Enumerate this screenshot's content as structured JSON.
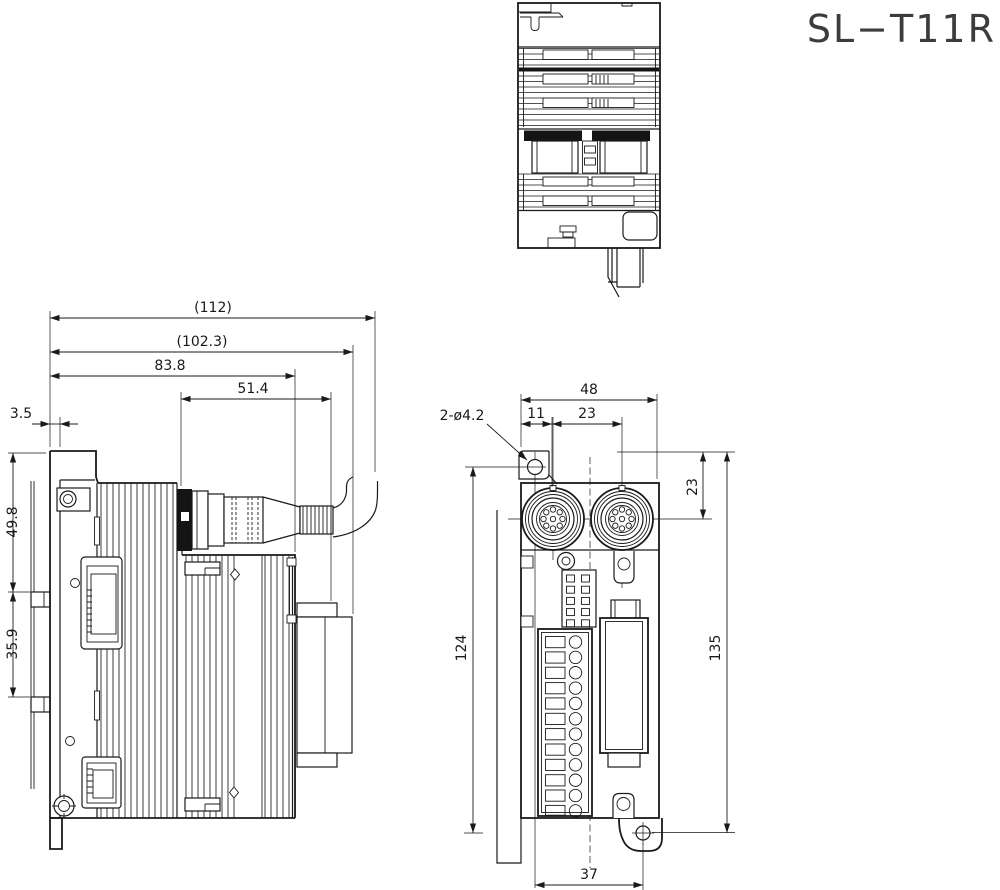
{
  "title": "SL−T11R",
  "colors": {
    "line": "#1a1a1a",
    "background": "#ffffff"
  },
  "dims": {
    "side_view": {
      "overall_depth": "(112)",
      "depth_with_cover": "(102.3)",
      "body_depth": "83.8",
      "connector_depth": "51.4",
      "plate_offset": "3.5",
      "rail_to_top": "49.8",
      "rail_width": "35.9"
    },
    "front_view": {
      "body_width": "48",
      "connector_offset": "11",
      "connector_pitch": "23",
      "mounting_holes": "2-ø4.2",
      "connector_from_top": "23",
      "overall_height": "135",
      "hole_pitch": "124",
      "hole_offset": "37"
    }
  }
}
